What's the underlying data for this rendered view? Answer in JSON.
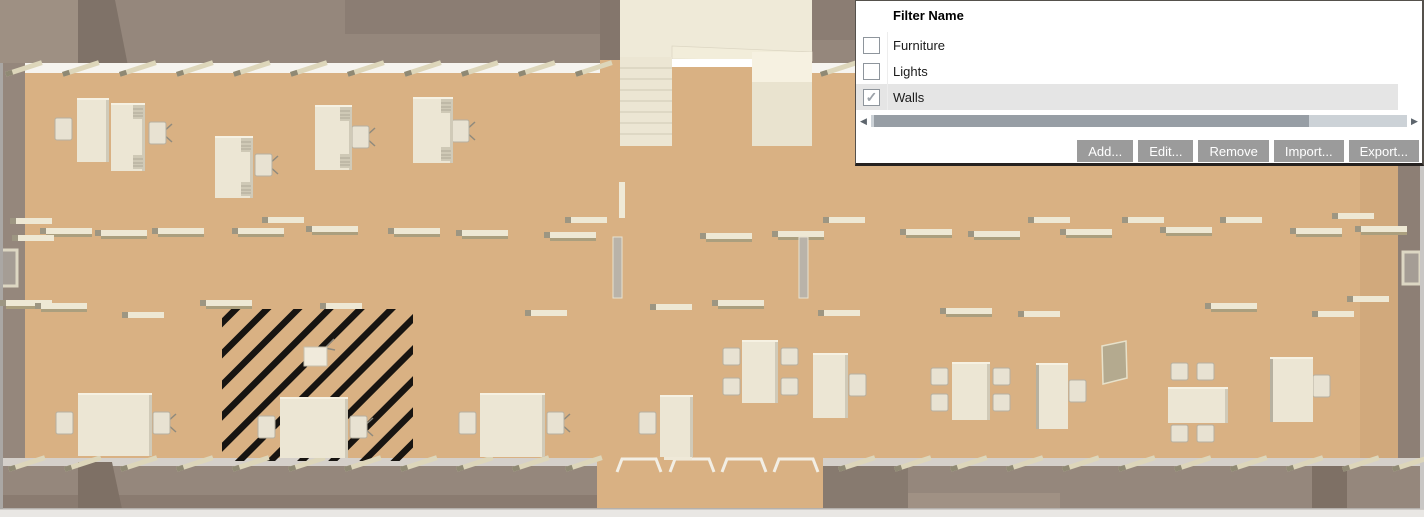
{
  "dialog": {
    "title": "Filter Name",
    "filters": [
      {
        "name": "Furniture",
        "checked": false,
        "selected": false
      },
      {
        "name": "Lights",
        "checked": false,
        "selected": false
      },
      {
        "name": "Walls",
        "checked": true,
        "selected": true
      }
    ],
    "check_glyph": "✓",
    "scrollbar": {
      "orientation": "horizontal",
      "left_glyph": "◀",
      "right_glyph": "▶"
    },
    "buttons": [
      {
        "label": "Add...",
        "name": "add-button"
      },
      {
        "label": "Edit...",
        "name": "edit-button"
      },
      {
        "label": "Remove",
        "name": "remove-button"
      },
      {
        "label": "Import...",
        "name": "import-button"
      },
      {
        "label": "Export...",
        "name": "export-button"
      }
    ]
  },
  "colors": {
    "floor": "#d9b183",
    "wall": "#95877c",
    "wall_dark": "#7f7268",
    "furniture": "#ece6d4",
    "hatch": "#171411",
    "selection_highlight": "#e5e5e5",
    "button_bg": "#9b9b9b",
    "button_text": "#ffffff"
  },
  "scene": {
    "ceiling_lights": [
      {
        "x": 262,
        "y": 217
      },
      {
        "x": 565,
        "y": 217
      },
      {
        "x": 823,
        "y": 217
      },
      {
        "x": 1028,
        "y": 217
      },
      {
        "x": 1122,
        "y": 217
      },
      {
        "x": 1220,
        "y": 217
      },
      {
        "x": 1332,
        "y": 213
      },
      {
        "x": 10,
        "y": 218
      },
      {
        "x": 40,
        "y": 228,
        "o": 1
      },
      {
        "x": 12,
        "y": 235
      },
      {
        "x": 95,
        "y": 230,
        "o": 1
      },
      {
        "x": 152,
        "y": 228,
        "o": 1
      },
      {
        "x": 232,
        "y": 228,
        "o": 1
      },
      {
        "x": 306,
        "y": 226,
        "o": 1
      },
      {
        "x": 388,
        "y": 228,
        "o": 1
      },
      {
        "x": 456,
        "y": 230,
        "o": 1
      },
      {
        "x": 544,
        "y": 232,
        "o": 1
      },
      {
        "x": 700,
        "y": 233,
        "o": 1
      },
      {
        "x": 772,
        "y": 231,
        "o": 1
      },
      {
        "x": 900,
        "y": 229,
        "o": 1
      },
      {
        "x": 968,
        "y": 231,
        "o": 1
      },
      {
        "x": 1060,
        "y": 229,
        "o": 1
      },
      {
        "x": 1160,
        "y": 227,
        "o": 1
      },
      {
        "x": 1290,
        "y": 228,
        "o": 1
      },
      {
        "x": 1355,
        "y": 226,
        "o": 1
      },
      {
        "x": 0,
        "y": 300,
        "o": 1
      },
      {
        "x": 35,
        "y": 303,
        "o": 1
      },
      {
        "x": 122,
        "y": 312
      },
      {
        "x": 200,
        "y": 300,
        "o": 1
      },
      {
        "x": 320,
        "y": 303
      },
      {
        "x": 525,
        "y": 310
      },
      {
        "x": 650,
        "y": 304
      },
      {
        "x": 712,
        "y": 300,
        "o": 1
      },
      {
        "x": 818,
        "y": 310
      },
      {
        "x": 940,
        "y": 308,
        "o": 1
      },
      {
        "x": 1018,
        "y": 311
      },
      {
        "x": 1205,
        "y": 303,
        "o": 1
      },
      {
        "x": 1312,
        "y": 311
      },
      {
        "x": 1347,
        "y": 296
      }
    ],
    "sill_lights_top_x": [
      5,
      62,
      119,
      176,
      233,
      290,
      347,
      404,
      461,
      518,
      575,
      820
    ],
    "sill_lights_bottom_x": [
      8,
      64,
      120,
      176,
      232,
      288,
      344,
      400,
      456,
      512,
      565,
      838,
      894,
      950,
      1006,
      1062,
      1118,
      1174,
      1230,
      1286,
      1342,
      1392
    ],
    "gap_marks_x": [
      617,
      670,
      722,
      774
    ],
    "hatch_region": {
      "x": 222,
      "y": 309,
      "w": 191,
      "h": 152
    },
    "desks": [
      {
        "x": 77,
        "y": 98,
        "w": 32,
        "h": 64
      },
      {
        "x": 111,
        "y": 103,
        "w": 34,
        "h": 68,
        "v": 1
      },
      {
        "x": 215,
        "y": 136,
        "w": 38,
        "h": 62,
        "v": 1
      },
      {
        "x": 315,
        "y": 105,
        "w": 37,
        "h": 65,
        "v": 1
      },
      {
        "x": 413,
        "y": 97,
        "w": 40,
        "h": 66,
        "v": 1
      },
      {
        "x": 78,
        "y": 393,
        "w": 74,
        "h": 63
      },
      {
        "x": 280,
        "y": 397,
        "w": 68,
        "h": 61
      },
      {
        "x": 480,
        "y": 393,
        "w": 65,
        "h": 64
      },
      {
        "x": 660,
        "y": 395,
        "w": 33,
        "h": 62
      },
      {
        "x": 813,
        "y": 353,
        "w": 35,
        "h": 65
      },
      {
        "x": 1036,
        "y": 363,
        "w": 32,
        "h": 66,
        "eL": 1
      },
      {
        "x": 1270,
        "y": 357,
        "w": 43,
        "h": 65,
        "eL": 1
      }
    ],
    "desk_chairs": [
      {
        "x": 55,
        "y": 118
      },
      {
        "x": 149,
        "y": 122,
        "l": 1
      },
      {
        "x": 255,
        "y": 154,
        "l": 1
      },
      {
        "x": 352,
        "y": 126,
        "l": 1
      },
      {
        "x": 452,
        "y": 120,
        "l": 1
      },
      {
        "x": 56,
        "y": 412
      },
      {
        "x": 153,
        "y": 412,
        "l": 1
      },
      {
        "x": 258,
        "y": 416
      },
      {
        "x": 350,
        "y": 416,
        "l": 1
      },
      {
        "x": 459,
        "y": 412
      },
      {
        "x": 547,
        "y": 412,
        "l": 1
      },
      {
        "x": 639,
        "y": 412
      },
      {
        "x": 849,
        "y": 374
      },
      {
        "x": 1069,
        "y": 380
      },
      {
        "x": 1313,
        "y": 375
      }
    ],
    "tables": [
      {
        "x": 742,
        "y": 340,
        "w": 36,
        "h": 63
      },
      {
        "x": 952,
        "y": 362,
        "w": 38,
        "h": 58
      },
      {
        "x": 1168,
        "y": 387,
        "w": 60,
        "h": 36
      }
    ],
    "table_chairs": [
      {
        "x": 723,
        "y": 348
      },
      {
        "x": 723,
        "y": 378
      },
      {
        "x": 781,
        "y": 348
      },
      {
        "x": 781,
        "y": 378
      },
      {
        "x": 931,
        "y": 368
      },
      {
        "x": 931,
        "y": 394
      },
      {
        "x": 993,
        "y": 368
      },
      {
        "x": 993,
        "y": 394
      },
      {
        "x": 1171,
        "y": 363
      },
      {
        "x": 1197,
        "y": 363
      },
      {
        "x": 1171,
        "y": 425
      },
      {
        "x": 1197,
        "y": 425
      }
    ]
  }
}
